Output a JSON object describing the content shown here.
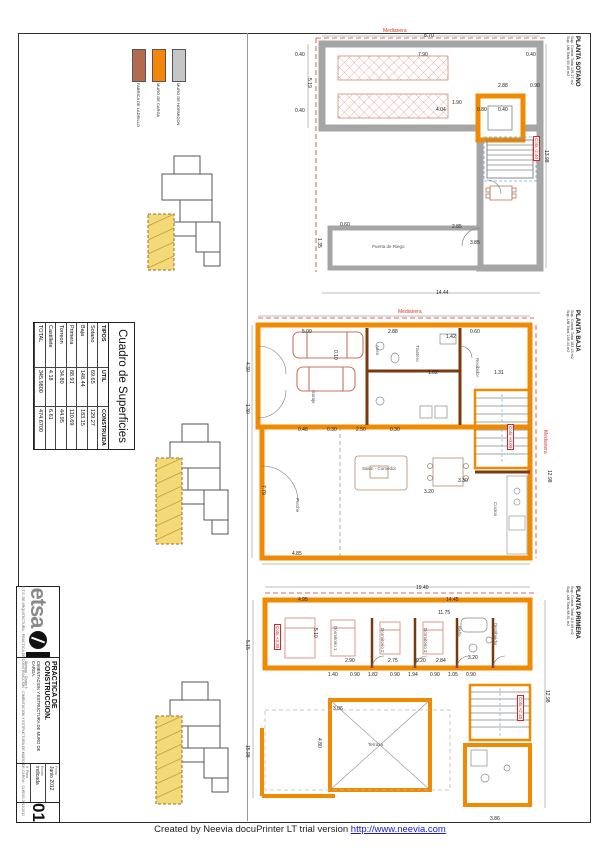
{
  "footer": {
    "created_by": "Created by Neevia docuPrinter LT trial version",
    "link": "http://www.neevia.com"
  },
  "legend": {
    "items": [
      {
        "label": "FABRICA DE LADRILLO",
        "color": "#b26b4e"
      },
      {
        "label": "MURO DE CARGA",
        "color": "#f5860a"
      },
      {
        "label": "MURO DE HORMIGON",
        "color": "#c6c6c6"
      }
    ]
  },
  "surfaces_table": {
    "title": "Cuadro de Superficies",
    "headers": [
      "TIPOS",
      "UTIL",
      "CONSTRUIDA"
    ],
    "rows": [
      {
        "tipo": "Sotano",
        "util": "69.65",
        "construida": "129.27"
      },
      {
        "tipo": "Baja",
        "util": "148.44",
        "construida": "183.15"
      },
      {
        "tipo": "Primera",
        "util": "88.91",
        "construida": "110.69"
      },
      {
        "tipo": "Torreon",
        "util": "34.80",
        "construida": "44.95"
      },
      {
        "tipo": "Castillete",
        "util": "4.18",
        "construida": "6.61"
      },
      {
        "tipo": "TOTAL",
        "util": "345.9800",
        "construida": "474.6700"
      }
    ]
  },
  "titleblock": {
    "logo_text": "etsa",
    "title": "PRACTICA DE CONSTRUCCION.",
    "subtitle": "CIMENTACION Y ESTRUCTURA DE MURO DE CARGA.",
    "alumno": "Alumno · Grupo 4",
    "fecha_label": "Fecha",
    "fecha": "Junio 2012",
    "escala_label": "Escala",
    "escala": "indicada",
    "num_label": "N. Plano",
    "numero": "01",
    "credits": "E.T.S. DE ARQUITECTURA · PRACTICA DE CONSTRUCCION · CIMENTACION Y ESTRUCTURA DE MURO DE CARGA · CURSO 2011/2012"
  },
  "plans": {
    "sotano": {
      "title": "PLANTA SOTANO",
      "sub1": "Sup. Constr. Total 129.27 m2",
      "sub2": "Sup. Util Total 69.65 m2",
      "cotas": [
        {
          "t": "Cota -2.40",
          "x": 540,
          "y": 136,
          "r": 90
        }
      ],
      "dims": [
        {
          "t": "Medianera",
          "x": 383,
          "y": 28,
          "c": "#d43a2a"
        },
        {
          "t": "8.70",
          "x": 424,
          "y": 33
        },
        {
          "t": "7.90",
          "x": 418,
          "y": 52
        },
        {
          "t": "0.40",
          "x": 295,
          "y": 52
        },
        {
          "t": "0.40",
          "x": 526,
          "y": 52
        },
        {
          "t": "5.19",
          "x": 312,
          "y": 78,
          "r": 90
        },
        {
          "t": "0.40",
          "x": 295,
          "y": 108
        },
        {
          "t": "2.88",
          "x": 498,
          "y": 83
        },
        {
          "t": "0.90",
          "x": 530,
          "y": 83
        },
        {
          "t": "4.04",
          "x": 436,
          "y": 107
        },
        {
          "t": "1.90",
          "x": 452,
          "y": 100
        },
        {
          "t": "0.80",
          "x": 477,
          "y": 107
        },
        {
          "t": "0.40",
          "x": 498,
          "y": 107
        },
        {
          "t": "2.85",
          "x": 452,
          "y": 224
        },
        {
          "t": "0.60",
          "x": 340,
          "y": 222
        },
        {
          "t": "1.35",
          "x": 322,
          "y": 238,
          "r": 90
        },
        {
          "t": "3.85",
          "x": 470,
          "y": 240
        },
        {
          "t": "14.44",
          "x": 436,
          "y": 290
        },
        {
          "t": "13.98",
          "x": 549,
          "y": 150,
          "r": 90
        }
      ],
      "rooms": [
        {
          "t": "Puerta de Riego",
          "x": 372,
          "y": 244
        }
      ]
    },
    "baja": {
      "title": "PLANTA BAJA",
      "sub1": "Sup. Constr. Total 183.15 m2",
      "sub2": "Sup. Util Total 148.44 m2",
      "cotas": [
        {
          "t": "Cota +0.00",
          "x": 514,
          "y": 424,
          "r": 90
        }
      ],
      "dims": [
        {
          "t": "Medianera",
          "x": 398,
          "y": 309,
          "c": "#d43a2a"
        },
        {
          "t": "Medianera",
          "x": 548,
          "y": 430,
          "r": 90,
          "c": "#d43a2a"
        },
        {
          "t": "5.00",
          "x": 302,
          "y": 329
        },
        {
          "t": "2.88",
          "x": 388,
          "y": 329
        },
        {
          "t": "1.42",
          "x": 446,
          "y": 334
        },
        {
          "t": "0.60",
          "x": 470,
          "y": 329
        },
        {
          "t": "4.30",
          "x": 250,
          "y": 362,
          "r": 90
        },
        {
          "t": "1.30",
          "x": 250,
          "y": 404,
          "r": 90
        },
        {
          "t": "1.02",
          "x": 428,
          "y": 370
        },
        {
          "t": "1.31",
          "x": 494,
          "y": 370
        },
        {
          "t": "0.10",
          "x": 338,
          "y": 350,
          "r": 90
        },
        {
          "t": "0.48",
          "x": 298,
          "y": 427
        },
        {
          "t": "0.30",
          "x": 327,
          "y": 427
        },
        {
          "t": "2.50",
          "x": 356,
          "y": 427
        },
        {
          "t": "0.30",
          "x": 390,
          "y": 427
        },
        {
          "t": "7.79",
          "x": 266,
          "y": 485,
          "r": 90
        },
        {
          "t": "3.20",
          "x": 424,
          "y": 489
        },
        {
          "t": "3.30",
          "x": 458,
          "y": 478
        },
        {
          "t": "4.85",
          "x": 292,
          "y": 551
        },
        {
          "t": "12.98",
          "x": 552,
          "y": 470,
          "r": 90
        }
      ],
      "rooms": [
        {
          "t": "Garaje",
          "x": 316,
          "y": 390,
          "r": 90
        },
        {
          "t": "Aseo",
          "x": 380,
          "y": 345,
          "r": 90
        },
        {
          "t": "Trastero",
          "x": 420,
          "y": 345,
          "r": 90
        },
        {
          "t": "Recibidor",
          "x": 480,
          "y": 358,
          "r": 90
        },
        {
          "t": "Salon - Comedor",
          "x": 362,
          "y": 466
        },
        {
          "t": "Cocina",
          "x": 498,
          "y": 502,
          "r": 90
        },
        {
          "t": "Porche",
          "x": 300,
          "y": 498,
          "r": 90
        }
      ]
    },
    "primera": {
      "title": "PLANTA PRIMERA",
      "sub1": "Sup. Constr. Total 110.69 m2",
      "sub2": "Sup. Util Total 88.91 m2",
      "cotas": [
        {
          "t": "Cota +3.30",
          "x": 281,
          "y": 624,
          "r": 90
        },
        {
          "t": "Cota +2.45",
          "x": 524,
          "y": 695,
          "r": 90
        }
      ],
      "dims": [
        {
          "t": "19.40",
          "x": 416,
          "y": 585
        },
        {
          "t": "14.45",
          "x": 446,
          "y": 597
        },
        {
          "t": "4.95",
          "x": 298,
          "y": 597
        },
        {
          "t": "11.75",
          "x": 438,
          "y": 610
        },
        {
          "t": "5.10",
          "x": 318,
          "y": 628,
          "r": 90
        },
        {
          "t": "2.90",
          "x": 345,
          "y": 658
        },
        {
          "t": "2.75",
          "x": 388,
          "y": 658
        },
        {
          "t": "0.20",
          "x": 416,
          "y": 658
        },
        {
          "t": "2.84",
          "x": 436,
          "y": 658
        },
        {
          "t": "3.20",
          "x": 468,
          "y": 655
        },
        {
          "t": "1.40",
          "x": 328,
          "y": 672
        },
        {
          "t": "0.90",
          "x": 350,
          "y": 672
        },
        {
          "t": "1.82",
          "x": 368,
          "y": 672
        },
        {
          "t": "0.90",
          "x": 390,
          "y": 672
        },
        {
          "t": "1.94",
          "x": 408,
          "y": 672
        },
        {
          "t": "0.90",
          "x": 430,
          "y": 672
        },
        {
          "t": "1.05",
          "x": 448,
          "y": 672
        },
        {
          "t": "0.90",
          "x": 466,
          "y": 672
        },
        {
          "t": "5.15",
          "x": 250,
          "y": 640,
          "r": 90
        },
        {
          "t": "15.98",
          "x": 250,
          "y": 745,
          "r": 90
        },
        {
          "t": "3.06",
          "x": 333,
          "y": 706
        },
        {
          "t": "4.80",
          "x": 322,
          "y": 738,
          "r": 90
        },
        {
          "t": "12.98",
          "x": 550,
          "y": 690,
          "r": 90
        },
        {
          "t": "3.86",
          "x": 490,
          "y": 816
        }
      ],
      "rooms": [
        {
          "t": "Dormitorio 1",
          "x": 338,
          "y": 626,
          "r": 90
        },
        {
          "t": "Dormitorio 2",
          "x": 385,
          "y": 628,
          "r": 90
        },
        {
          "t": "Dormitorio 3",
          "x": 428,
          "y": 628,
          "r": 90
        },
        {
          "t": "Baño",
          "x": 462,
          "y": 626,
          "r": 90
        },
        {
          "t": "Distribuidor",
          "x": 498,
          "y": 623,
          "r": 90
        },
        {
          "t": "Terraza",
          "x": 368,
          "y": 742
        }
      ]
    }
  }
}
